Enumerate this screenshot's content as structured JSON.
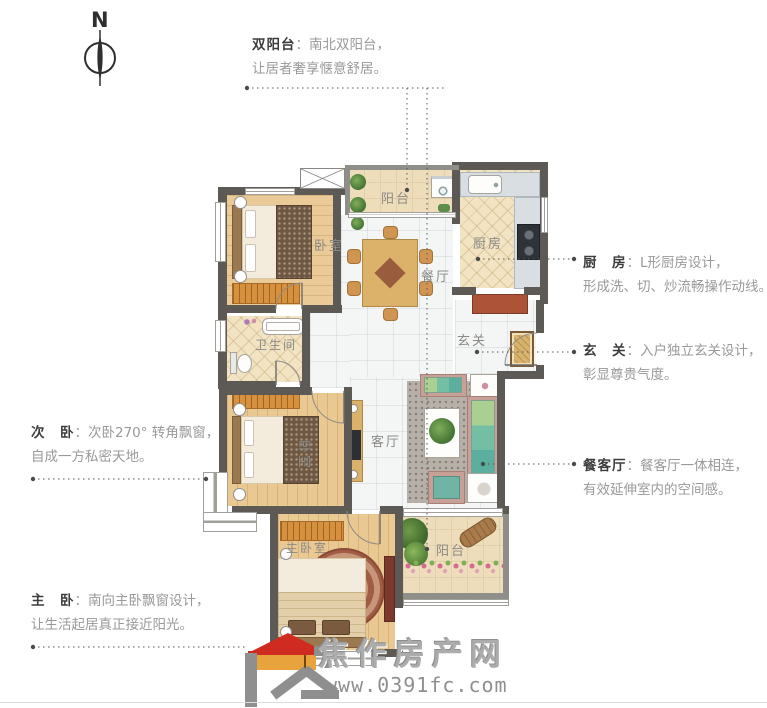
{
  "compass": {
    "label": "N"
  },
  "annotations": {
    "colon": "：",
    "double_balcony": {
      "title": "双阳台",
      "line1": "南北双阳台，",
      "line2": "让居者奢享惬意舒居。"
    },
    "kitchen": {
      "title": "厨　房",
      "line1": "L形厨房设计，",
      "line2": "形成洗、切、炒流畅操作动线。"
    },
    "foyer": {
      "title": "玄　关",
      "line1": "入户独立玄关设计，",
      "line2": "彰显尊贵气度。"
    },
    "dining_living": {
      "title": "餐客厅",
      "line1": "餐客厅一体相连，",
      "line2": "有效延伸室内的空间感。"
    },
    "second_bedroom": {
      "title": "次　卧",
      "line1": "次卧270° 转角飘窗，",
      "line2": "自成一方私密天地。"
    },
    "master_bedroom": {
      "title": "主　卧",
      "line1": "南向主卧飘窗设计，",
      "line2": "让生活起居真正接近阳光。"
    }
  },
  "room_labels": {
    "balcony_north": "阳台",
    "kitchen": "厨房",
    "dining": "餐厅",
    "foyer": "玄关",
    "bathroom": "卫生间",
    "bedroom_north": "卧室",
    "bedroom_west": "卧室",
    "living": "客厅",
    "master_bedroom": "主卧室",
    "balcony_south": "阳台"
  },
  "watermark": {
    "site_name": "焦作房产网",
    "site_url": "www.0391fc.com"
  },
  "colors": {
    "wall": "#5d5a55",
    "wood_floor": "#e9c892",
    "tile_floor": "#f4f5f5",
    "kitchen_floor": "#f2e3c2",
    "wardrobe": "#d6913f",
    "counter": "#d8dee2",
    "entry_cabinet": "#ad5338",
    "sofa_green": "#74bfa4",
    "logo_red": "#cf2b20",
    "logo_orange": "#e8a33d",
    "annotation_title": "#3d3d3d",
    "annotation_body": "#999999",
    "watermark_gray": "#acacac"
  }
}
